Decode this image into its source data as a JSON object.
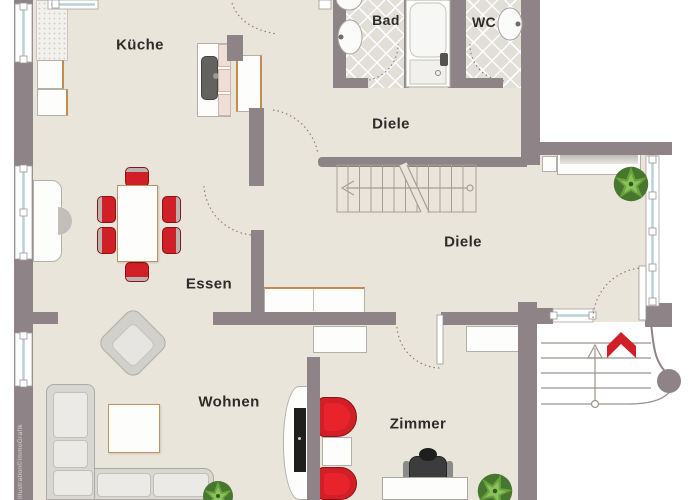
{
  "plan": {
    "rooms": {
      "kueche": {
        "label": "Küche"
      },
      "bad": {
        "label": "Bad"
      },
      "wc": {
        "label": "WC"
      },
      "diele_top": {
        "label": "Diele"
      },
      "diele_main": {
        "label": "Diele"
      },
      "essen": {
        "label": "Essen"
      },
      "wohnen": {
        "label": "Wohnen"
      },
      "zimmer": {
        "label": "Zimmer"
      }
    },
    "watermark": {
      "text": "Illustration©ImmoGrafik"
    }
  },
  "colors": {
    "wall": "#8e8487",
    "floor": "#eae5db",
    "tile": "#e2dfd9",
    "accent_red": "#d01f26",
    "line": "#a29b91",
    "glass": "#b8d2d8",
    "plant_green": "#47762e",
    "text": "#2e2c29"
  }
}
